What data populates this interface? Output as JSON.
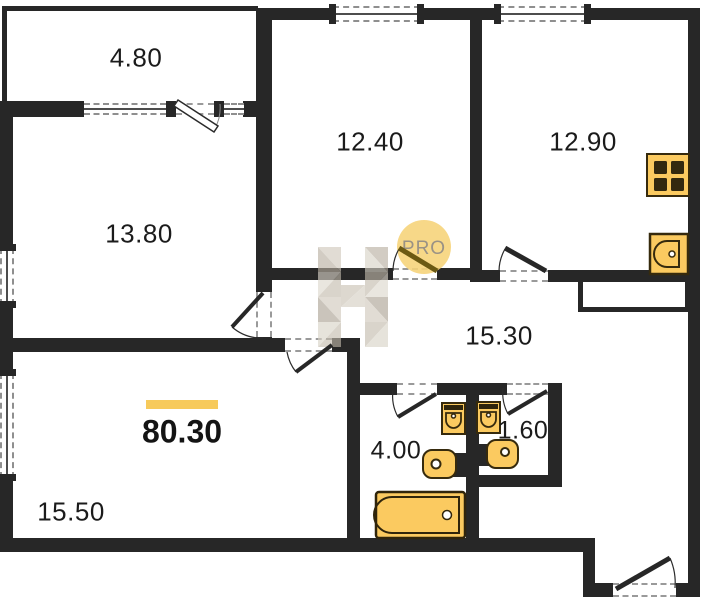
{
  "plan": {
    "total_area": "80.30",
    "watermark": {
      "badge_text": "PRO"
    },
    "rooms": [
      {
        "name": "balcony",
        "area": "4.80"
      },
      {
        "name": "room-12-40",
        "area": "12.40"
      },
      {
        "name": "kitchen",
        "area": "12.90"
      },
      {
        "name": "room-13-80",
        "area": "13.80"
      },
      {
        "name": "hallway",
        "area": "15.30"
      },
      {
        "name": "bathroom",
        "area": "4.00"
      },
      {
        "name": "wc",
        "area": "1.60"
      },
      {
        "name": "living-room",
        "area": "15.50"
      }
    ],
    "fixtures": [
      "stove",
      "kitchen-sink",
      "toilet",
      "toilet",
      "washbasin",
      "washbasin",
      "bathtub"
    ],
    "colors": {
      "wall": "#272727",
      "fixture_fill": "#fbca60",
      "fixture_stroke": "#362a0d",
      "accent": "#f7ca5b",
      "watermark_circle": "#f6d378",
      "watermark_text": "#9a9285"
    }
  }
}
